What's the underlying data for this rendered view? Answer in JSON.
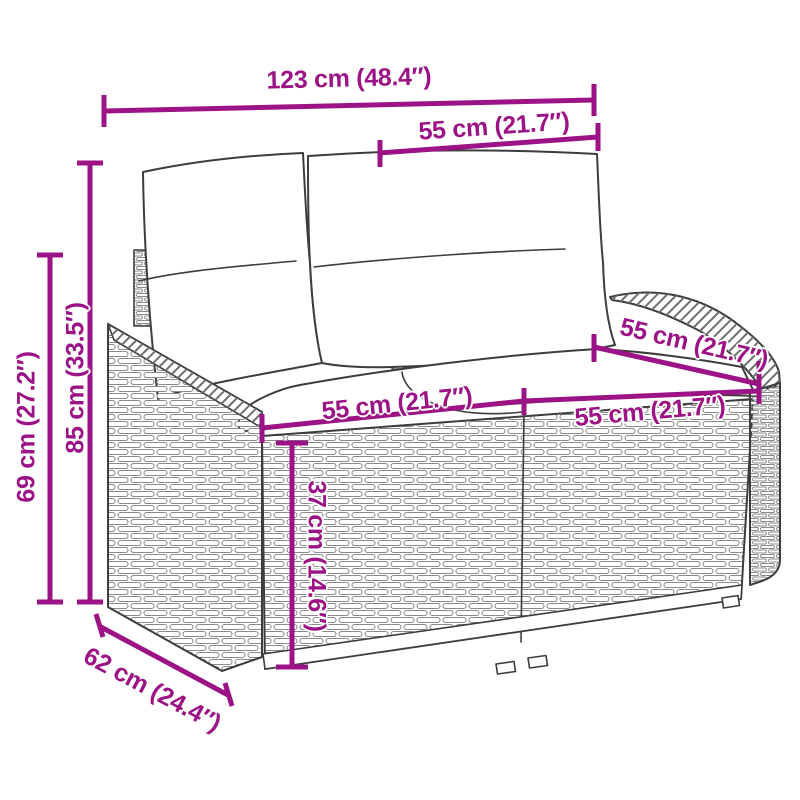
{
  "colors": {
    "dimension_accent": "#9C1385",
    "line_art": "#3D3D3D",
    "background": "#FFFFFF"
  },
  "figure": {
    "type": "furniture-dimension-diagram",
    "subject": "wicker-loveseat-with-cushions"
  },
  "dimensions": {
    "overall_width": {
      "label": "123 cm (48.4″)",
      "value_cm": 123,
      "value_in": 48.4
    },
    "backrest_width": {
      "label": "55 cm (21.7″)",
      "value_cm": 55,
      "value_in": 21.7
    },
    "overall_height": {
      "label": "85 cm (33.5″)",
      "value_cm": 85,
      "value_in": 33.5
    },
    "armrest_height": {
      "label": "69 cm (27.2″)",
      "value_cm": 69,
      "value_in": 27.2
    },
    "seat_width_left": {
      "label": "55 cm (21.7″)",
      "value_cm": 55,
      "value_in": 21.7
    },
    "seat_width_right": {
      "label": "55 cm (21.7″)",
      "value_cm": 55,
      "value_in": 21.7
    },
    "seat_depth": {
      "label": "55 cm (21.7″)",
      "value_cm": 55,
      "value_in": 21.7
    },
    "seat_height": {
      "label": "37 cm (14.6″)",
      "value_cm": 37,
      "value_in": 14.6
    },
    "overall_depth": {
      "label": "62 cm (24.4″)",
      "value_cm": 62,
      "value_in": 24.4
    }
  }
}
